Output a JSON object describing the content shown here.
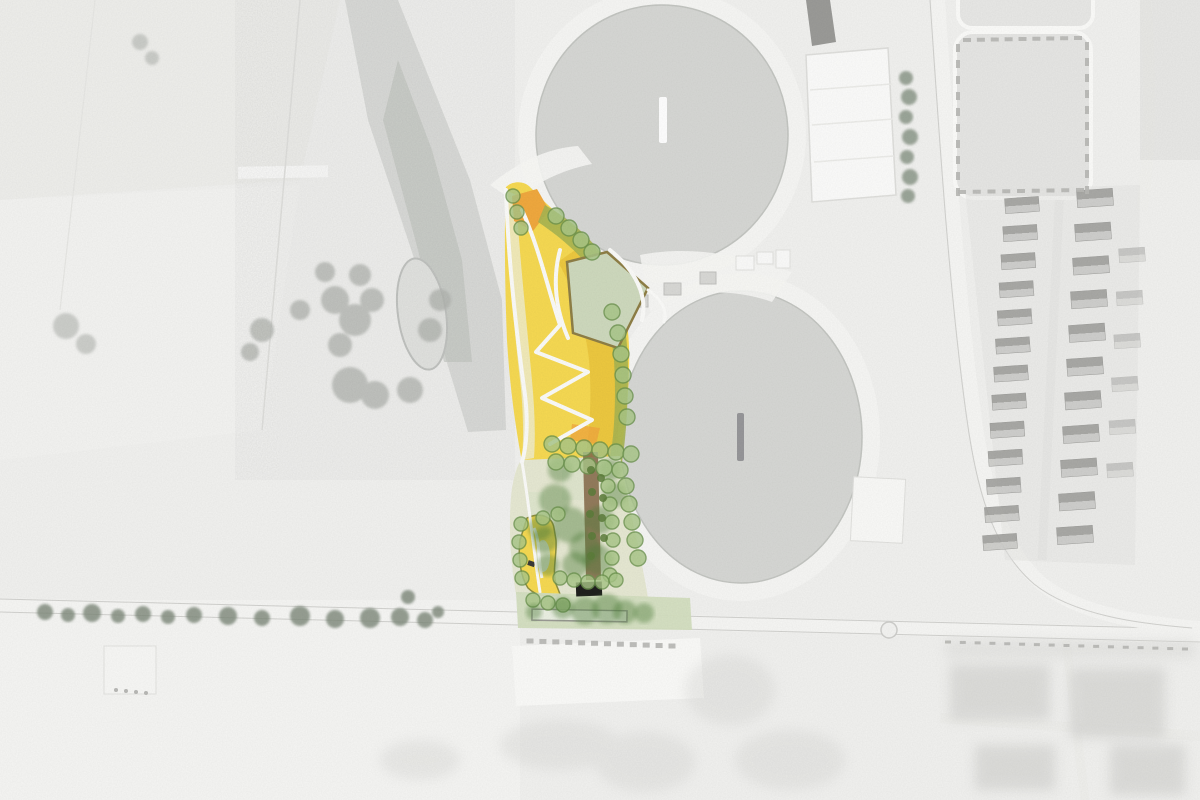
{
  "page": {
    "type": "aerial-photo-with-landscape-masterplan-overlay",
    "visible_text": []
  },
  "colors": {
    "photo-bg": "#f2f2f0",
    "field-light": "#ededeb",
    "veg-gray": "#cdcfcb",
    "veg-dark": "#bcbfba",
    "basin-fill": "#d7d8d5",
    "basin-rim": "#c4c6c2",
    "road-white": "#f7f7f5",
    "road-edge": "#d2d2cf",
    "plan-pale": "#f1ecc4",
    "plan-yellow": "#f7da52",
    "plan-gold": "#ecc63c",
    "plan-orange": "#f1a93e",
    "plan-olive": "#a9b551",
    "lawn-green": "#cfdabe",
    "lawn-edge": "#8f7f46",
    "khaki": "#e7e9d3",
    "strip-green": "#d4dfc0",
    "tree-fill": "#a9c788",
    "tree-stroke": "#6e9550",
    "canopy": "#4f7f3a",
    "brown-path": "#8a6f4f",
    "building-black": "#1f1f1d",
    "house-dark": "#a4a4a1",
    "house-light": "#cbcbc8",
    "gray-tree": "#7e897a"
  },
  "features": {
    "basins": [
      {
        "name": "storage-basin-north",
        "cx": 662,
        "cy": 135,
        "rx": 126,
        "ry": 130,
        "marker": {
          "x": 659,
          "y": 97,
          "w": 8,
          "h": 46,
          "fill": "#ffffff"
        }
      },
      {
        "name": "storage-basin-south",
        "cx": 741,
        "cy": 437,
        "rx": 121,
        "ry": 146,
        "marker": {
          "x": 737,
          "y": 413,
          "w": 7,
          "h": 48,
          "fill": "#97979a"
        }
      }
    ],
    "roundabout": {
      "cx": 889,
      "cy": 630,
      "r": 8
    },
    "tree_groups": [
      {
        "group": "g-plan-trees",
        "class": "tree",
        "name": "plan-tree-marker",
        "points": [
          [
            513,
            196,
            7
          ],
          [
            517,
            212,
            7
          ],
          [
            521,
            228,
            7
          ],
          [
            556,
            216,
            8
          ],
          [
            569,
            228,
            8
          ],
          [
            581,
            240,
            8
          ],
          [
            592,
            252,
            8
          ],
          [
            612,
            312,
            8
          ],
          [
            618,
            333,
            8
          ],
          [
            621,
            354,
            8
          ],
          [
            623,
            375,
            8
          ],
          [
            625,
            396,
            8
          ],
          [
            627,
            417,
            8
          ],
          [
            552,
            444,
            8
          ],
          [
            568,
            446,
            8
          ],
          [
            584,
            448,
            8
          ],
          [
            600,
            450,
            8
          ],
          [
            616,
            452,
            8
          ],
          [
            631,
            454,
            8
          ],
          [
            556,
            462,
            8
          ],
          [
            572,
            464,
            8
          ],
          [
            588,
            466,
            8
          ],
          [
            604,
            468,
            8
          ],
          [
            620,
            470,
            8
          ],
          [
            626,
            486,
            8
          ],
          [
            629,
            504,
            8
          ],
          [
            632,
            522,
            8
          ],
          [
            635,
            540,
            8
          ],
          [
            638,
            558,
            8
          ],
          [
            608,
            486,
            7
          ],
          [
            610,
            504,
            7
          ],
          [
            612,
            522,
            7
          ],
          [
            613,
            540,
            7
          ],
          [
            612,
            558,
            7
          ],
          [
            610,
            575,
            7
          ],
          [
            521,
            524,
            7
          ],
          [
            519,
            542,
            7
          ],
          [
            520,
            560,
            7
          ],
          [
            522,
            578,
            7
          ],
          [
            543,
            518,
            7
          ],
          [
            558,
            514,
            7
          ],
          [
            560,
            578,
            7
          ],
          [
            574,
            580,
            7
          ],
          [
            588,
            582,
            7
          ],
          [
            602,
            582,
            7
          ],
          [
            616,
            580,
            7
          ],
          [
            533,
            600,
            7
          ],
          [
            548,
            603,
            7
          ],
          [
            563,
            605,
            7
          ]
        ]
      },
      {
        "group": "g-olive-dots",
        "class": "odot",
        "name": "shrub-dot",
        "points": [
          [
            591,
            470,
            4
          ],
          [
            592,
            492,
            4
          ],
          [
            590,
            514,
            4
          ],
          [
            592,
            536,
            4
          ],
          [
            591,
            556,
            4
          ],
          [
            601,
            478,
            4
          ],
          [
            603,
            498,
            4
          ],
          [
            602,
            518,
            4
          ],
          [
            604,
            538,
            4
          ]
        ]
      },
      {
        "group": "g-canopies",
        "class": "canopy",
        "name": "tree-canopy",
        "points": [
          [
            555,
            500,
            16
          ],
          [
            570,
            525,
            18
          ],
          [
            585,
            548,
            16
          ],
          [
            560,
            470,
            12
          ],
          [
            600,
            520,
            14
          ],
          [
            615,
            495,
            12
          ],
          [
            598,
            560,
            15
          ],
          [
            575,
            565,
            13
          ],
          [
            545,
            540,
            13
          ],
          [
            548,
            565,
            11
          ],
          [
            540,
            528,
            12
          ],
          [
            610,
            470,
            11
          ]
        ]
      },
      {
        "group": "g-strip-canopies",
        "class": "canopy",
        "name": "roadside-canopy",
        "points": [
          [
            563,
            608,
            11
          ],
          [
            585,
            611,
            14
          ],
          [
            607,
            609,
            15
          ],
          [
            625,
            612,
            12
          ],
          [
            644,
            613,
            10
          ],
          [
            534,
            612,
            8
          ]
        ]
      },
      {
        "group": "g-road-trees",
        "class": "gtree",
        "name": "existing-road-tree",
        "points": [
          [
            45,
            612,
            8
          ],
          [
            68,
            615,
            7
          ],
          [
            92,
            613,
            9
          ],
          [
            118,
            616,
            7
          ],
          [
            143,
            614,
            8
          ],
          [
            168,
            617,
            7
          ],
          [
            194,
            615,
            8
          ],
          [
            228,
            616,
            9
          ],
          [
            262,
            618,
            8
          ],
          [
            300,
            616,
            10
          ],
          [
            335,
            619,
            9
          ],
          [
            370,
            618,
            10
          ],
          [
            400,
            617,
            9
          ],
          [
            425,
            620,
            8
          ],
          [
            438,
            612,
            6
          ],
          [
            408,
            597,
            7
          ]
        ]
      },
      {
        "group": "g-industrial-trees",
        "class": "itree",
        "name": "industrial-road-tree",
        "points": [
          [
            906,
            78,
            7
          ],
          [
            909,
            97,
            8
          ],
          [
            906,
            117,
            7
          ],
          [
            910,
            137,
            8
          ],
          [
            907,
            157,
            7
          ],
          [
            910,
            177,
            8
          ],
          [
            908,
            196,
            7
          ]
        ]
      }
    ],
    "house_rows": [
      {
        "group": "g-houses",
        "x0": 1022,
        "y0": 205,
        "x1": 1000,
        "y1": 542,
        "count": 13,
        "w": 34,
        "h": 15,
        "rot": -4
      },
      {
        "group": "g-houses",
        "x0": 1095,
        "y0": 198,
        "x1": 1075,
        "y1": 535,
        "count": 11,
        "w": 36,
        "h": 17,
        "rot": -4
      },
      {
        "group": "g-houses",
        "x0": 1132,
        "y0": 255,
        "x1": 1120,
        "y1": 470,
        "count": 6,
        "w": 26,
        "h": 14,
        "rot": -4,
        "cls": "faint"
      }
    ],
    "tick_rows": [
      {
        "group": "g-ticks",
        "x0": 530,
        "y0": 641,
        "x1": 672,
        "y1": 646,
        "count": 12,
        "w": 7,
        "h": 5
      },
      {
        "group": "g-ticks",
        "x0": 948,
        "y0": 642,
        "x1": 1185,
        "y1": 649,
        "count": 17,
        "w": 6,
        "h": 3
      },
      {
        "group": "g-ticks",
        "x0": 967,
        "y0": 40,
        "x1": 1078,
        "y1": 38,
        "count": 9,
        "w": 8,
        "h": 4
      },
      {
        "group": "g-ticks",
        "x0": 962,
        "y0": 192,
        "x1": 1080,
        "y1": 190,
        "count": 9,
        "w": 8,
        "h": 4
      },
      {
        "group": "g-ticks",
        "x0": 958,
        "y0": 48,
        "x1": 958,
        "y1": 192,
        "count": 10,
        "w": 4,
        "h": 8
      },
      {
        "group": "g-ticks",
        "x0": 1087,
        "y0": 46,
        "x1": 1087,
        "y1": 190,
        "count": 10,
        "w": 4,
        "h": 8
      }
    ]
  }
}
